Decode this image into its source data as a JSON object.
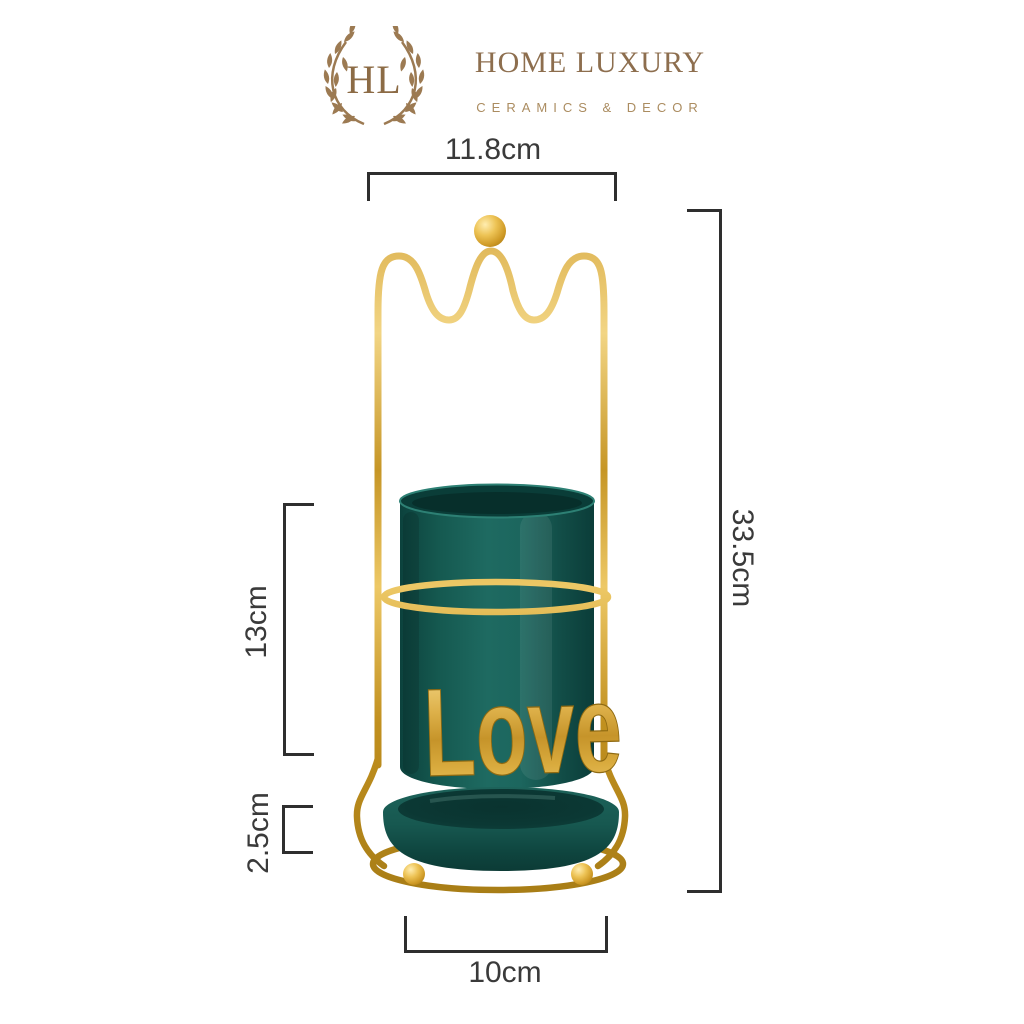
{
  "brand": {
    "initials": "HL",
    "name": "HOME LUXURY",
    "tagline": "CERAMICS & DECOR"
  },
  "dimensions": {
    "top_width": "11.8cm",
    "total_height": "33.5cm",
    "cup_height": "13cm",
    "tray_height": "2.5cm",
    "base_width": "10cm"
  },
  "product": {
    "love_text": "Love"
  },
  "colors": {
    "brand_brown": "#94734f",
    "tagline_tan": "#ab8c60",
    "dimension_line": "#2e2e2e",
    "gold": "#d2a335",
    "ceramic_green": "#175750"
  }
}
